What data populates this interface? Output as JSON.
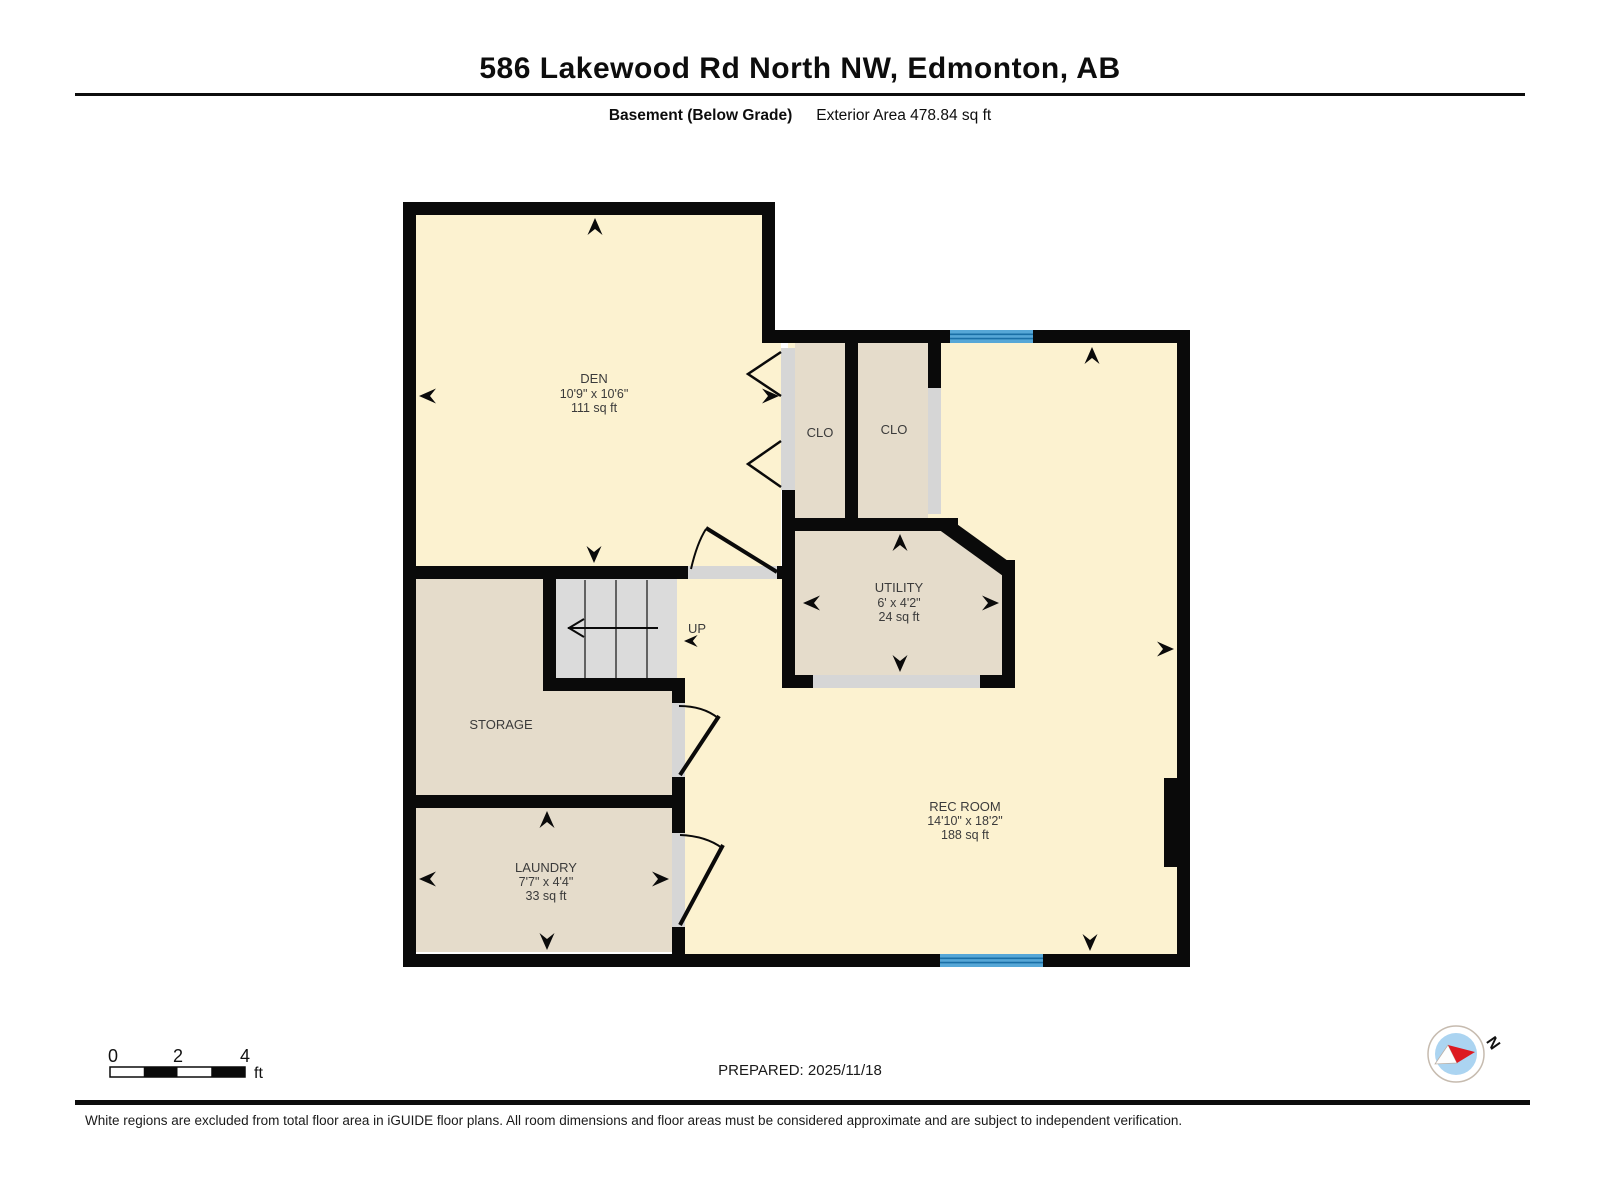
{
  "header": {
    "title": "586 Lakewood Rd North NW, Edmonton, AB",
    "floor_label": "Basement (Below Grade)",
    "area_label": "Exterior Area 478.84 sq ft"
  },
  "rooms": {
    "den": {
      "name": "DEN",
      "dims": "10'9\" x 10'6\"",
      "area": "111 sq ft"
    },
    "closet_left": {
      "name": "CLO"
    },
    "closet_right": {
      "name": "CLO"
    },
    "utility": {
      "name": "UTILITY",
      "dims": "6' x 4'2\"",
      "area": "24 sq ft"
    },
    "storage": {
      "name": "STORAGE"
    },
    "laundry": {
      "name": "LAUNDRY",
      "dims": "7'7\" x 4'4\"",
      "area": "33 sq ft"
    },
    "rec_room": {
      "name": "REC ROOM",
      "dims": "14'10\" x 18'2\"",
      "area": "188 sq ft"
    },
    "stairs": {
      "direction_label": "UP"
    }
  },
  "scale_bar": {
    "ticks": [
      "0",
      "2",
      "4"
    ],
    "unit": "ft"
  },
  "compass": {
    "north_label": "N"
  },
  "footer": {
    "prepared_label": "PREPARED: 2025/11/18",
    "disclaimer": "White regions are excluded from total floor area in iGUIDE floor plans. All room dimensions and floor areas must be considered approximate and are subject to independent verification."
  },
  "colors": {
    "room_fill": "#FCF2D0",
    "closet_fill": "#E5DCCB",
    "stairs_fill": "#DBDBDB",
    "door_gap": "#D6D6D6",
    "wall": "#0A0A0A",
    "window_fill": "#56A7D7",
    "window_stripe": "#1A6FA6",
    "compass_red": "#DD1A21",
    "compass_blue": "#ABD4F1"
  }
}
